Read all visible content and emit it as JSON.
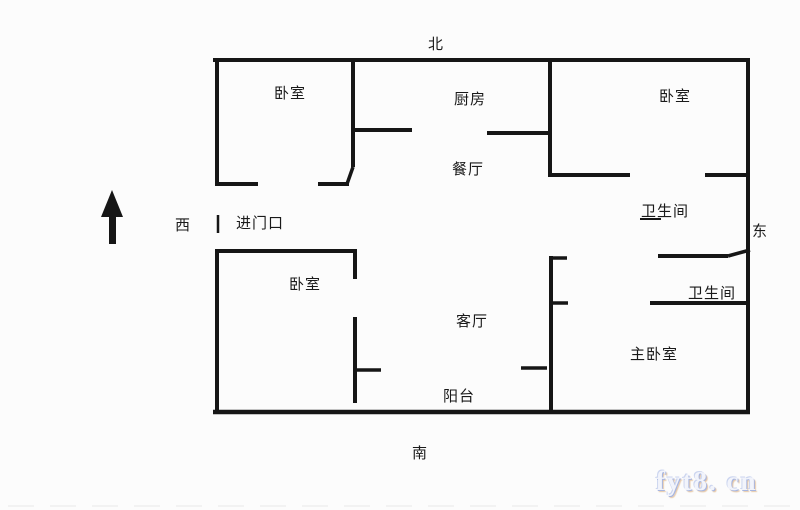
{
  "compass": {
    "north": "北",
    "south": "南",
    "west": "西",
    "east": "东"
  },
  "rooms": {
    "bedroom_nw": "卧室",
    "kitchen": "厨房",
    "bedroom_ne": "卧室",
    "dining": "餐厅",
    "entrance": "进门口",
    "bathroom_upper": "卫生间",
    "bathroom_lower": "卫生间",
    "bedroom_sw": "卧室",
    "living_room": "客厅",
    "master_bedroom": "主卧室",
    "balcony": "阳台"
  },
  "watermark": {
    "text": "fyt8. cn"
  },
  "colors": {
    "wall": "#161616",
    "background": "#fcfcfc",
    "watermark_blue": "#a8b6e0",
    "watermark_orange": "#cd873c"
  }
}
